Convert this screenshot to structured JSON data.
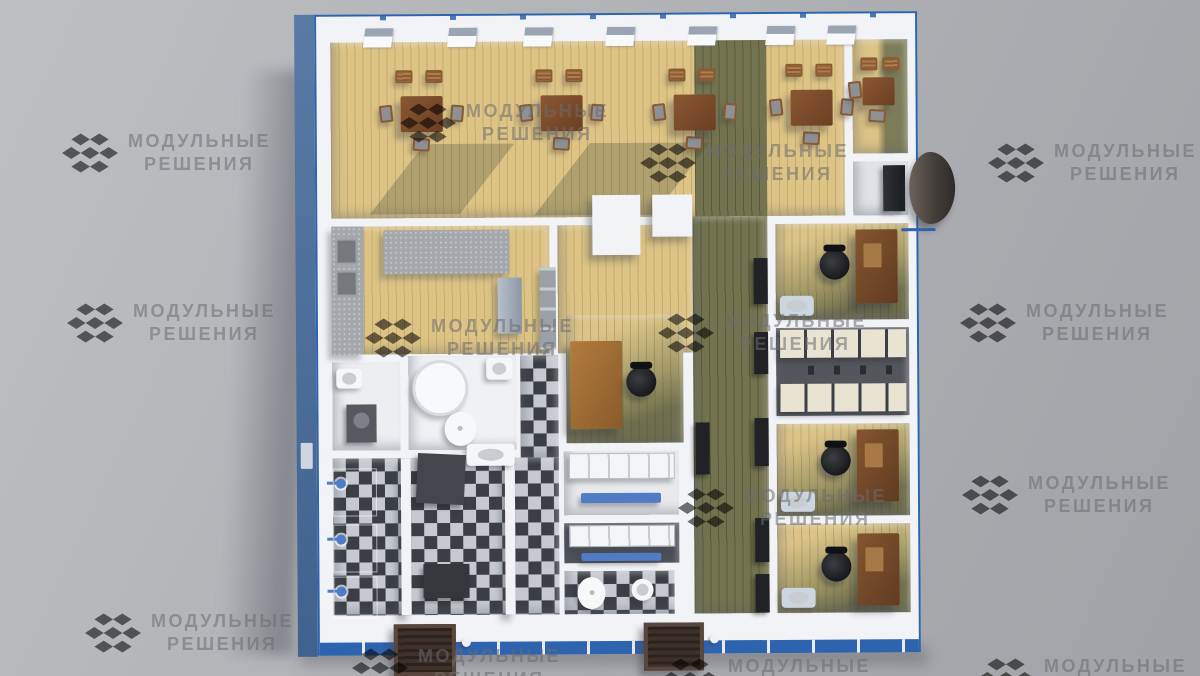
{
  "watermark": {
    "line1": "МОДУЛЬНЫЕ",
    "line2": "РЕШЕНИЯ",
    "logo": "cubes-logo"
  },
  "colors": {
    "background_top": "#bdbfc3",
    "background_bottom": "#a0a2a7",
    "watermark": "#6b6c70",
    "frame_blue": "#2e63ae",
    "exterior_blue": "#5a7aa6",
    "wall_white": "#f2f3f6",
    "floor_light_wood": "#ddc485",
    "floor_olive": "#73734f",
    "tile_dark": "#3b3e44",
    "tile_light": "#c6cad0",
    "counter_gray": "#a4a8ac",
    "table_brown": "#6b3f23",
    "desk_brown": "#7b4e2d",
    "chair_black": "#17181b",
    "fixture_blue": "#4f7cc4",
    "locker_cream": "#e9e3d2",
    "mat_brown": "#3e3129"
  }
}
